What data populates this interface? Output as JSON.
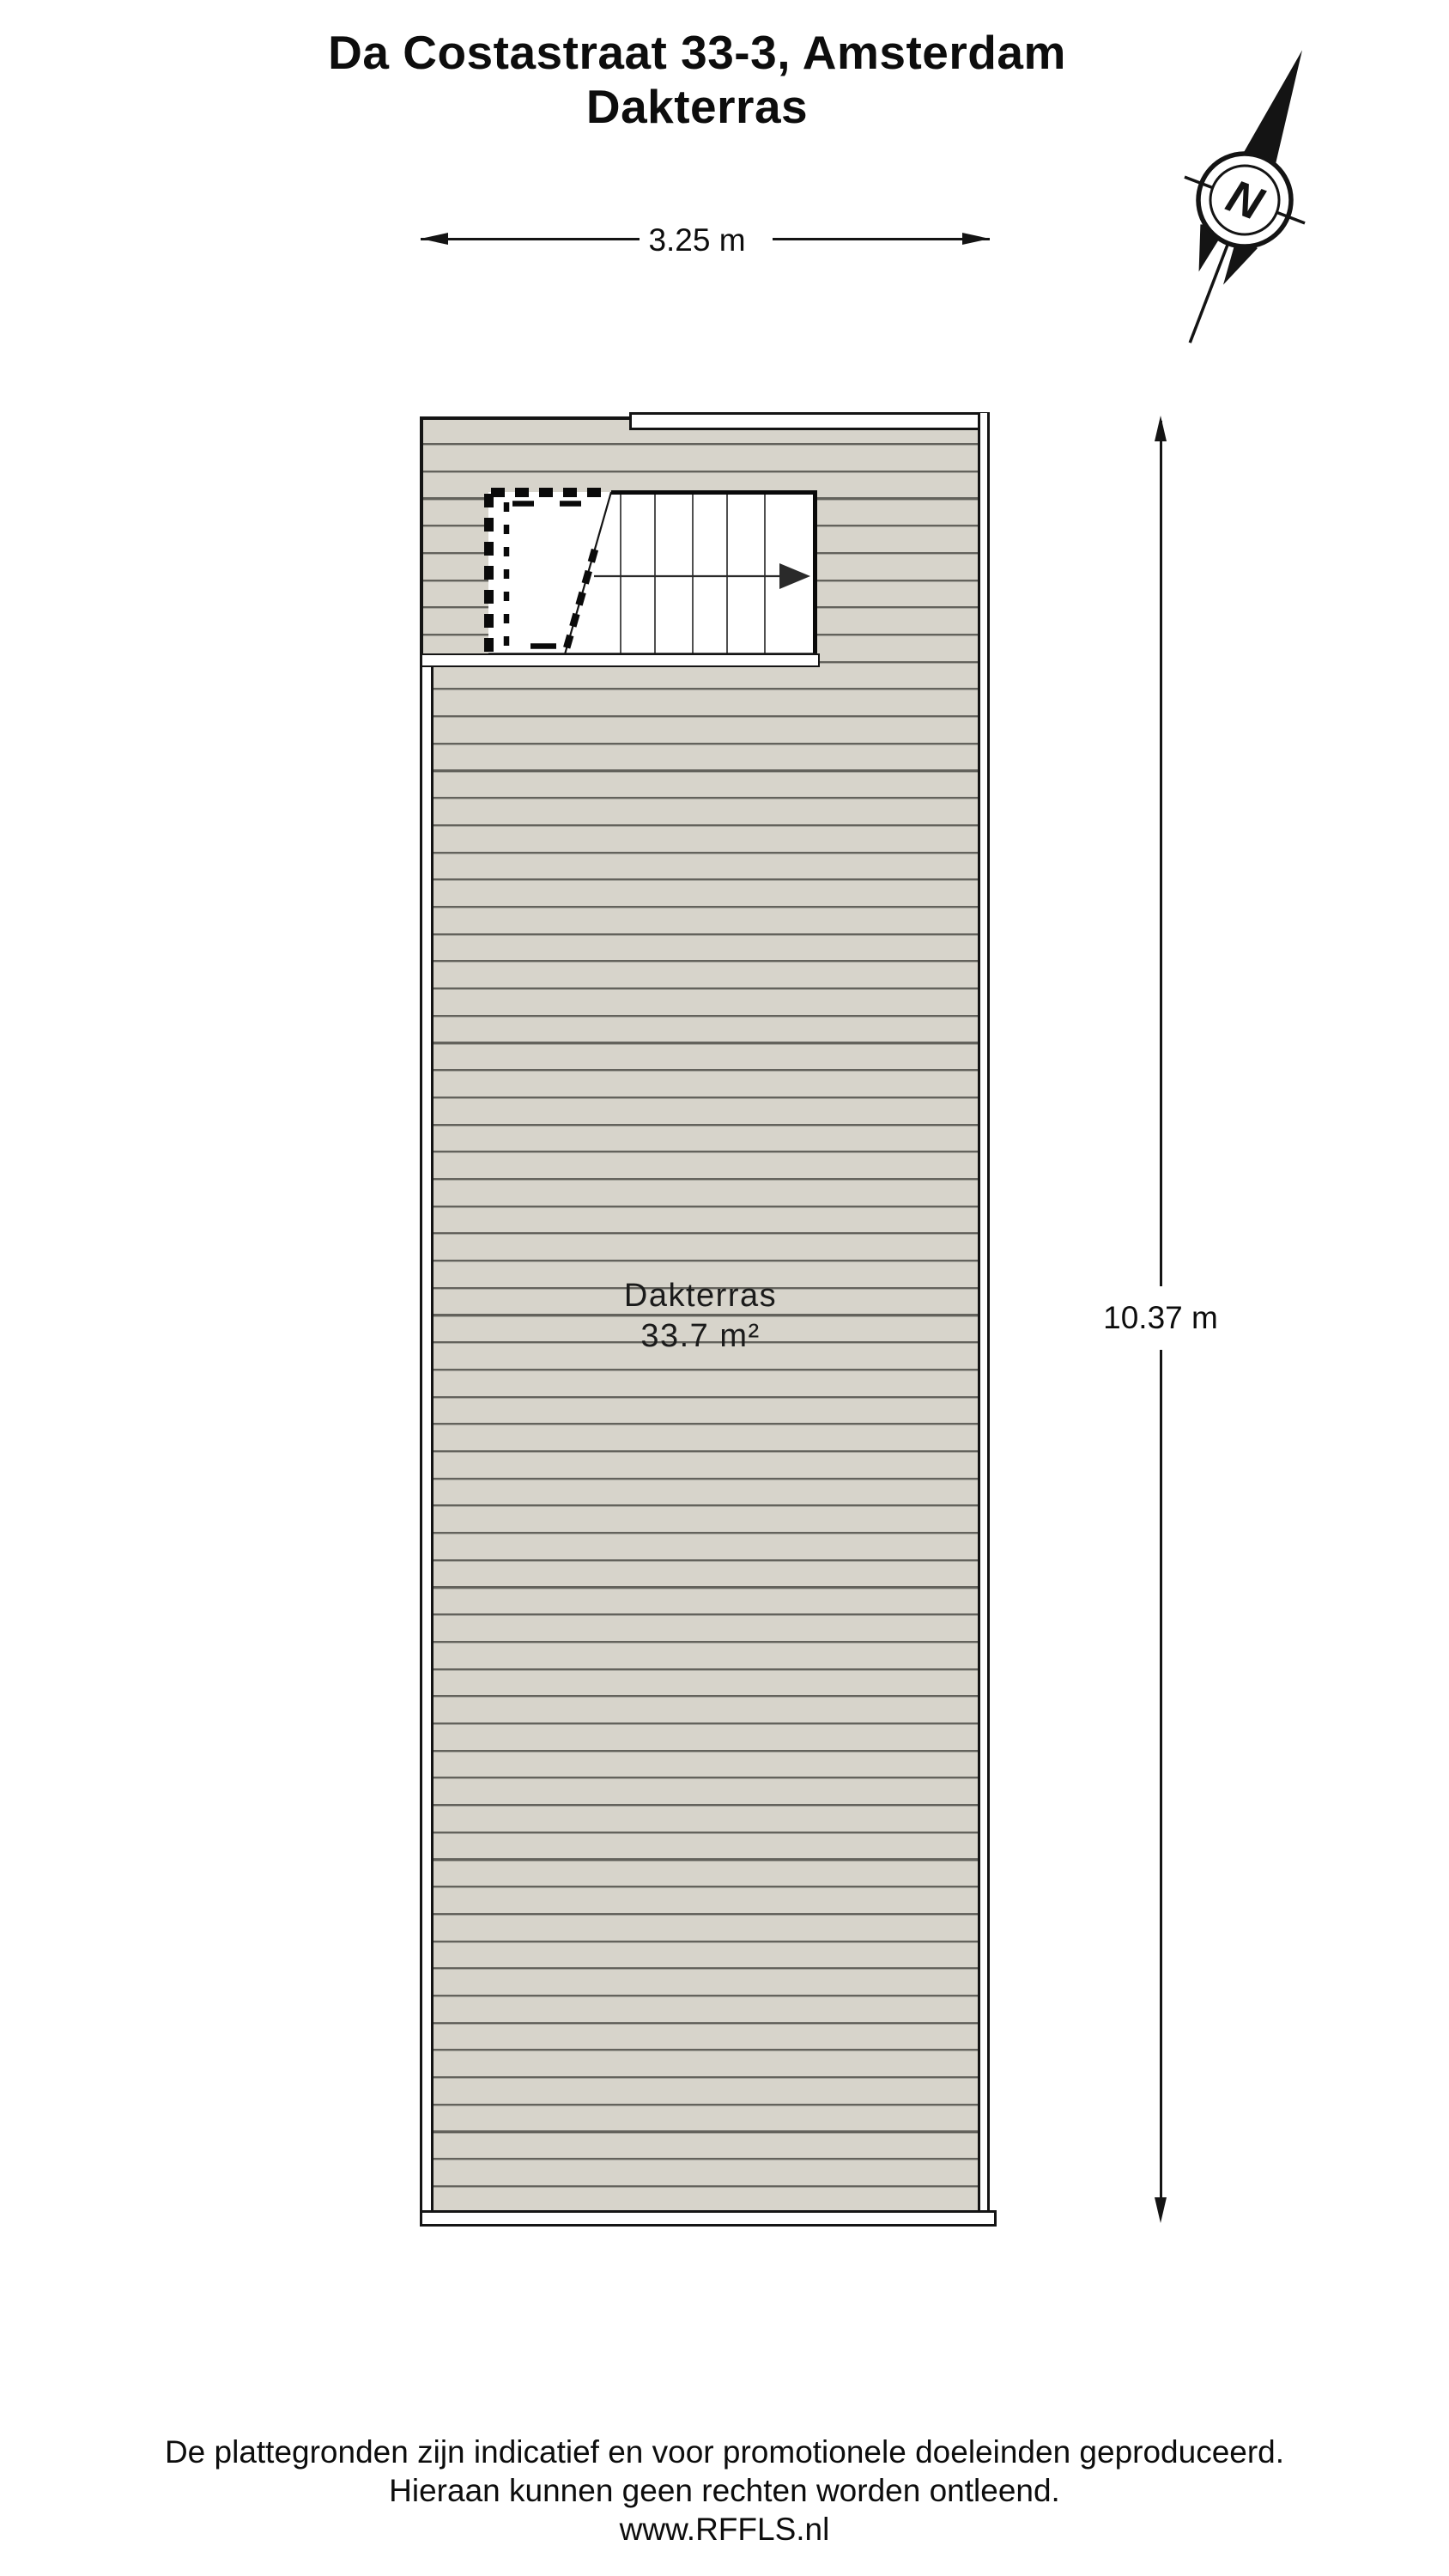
{
  "title": {
    "line1": "Da Costastraat 33-3, Amsterdam",
    "line2": "Dakterras"
  },
  "dimensions": {
    "width": "3.25 m",
    "height": "10.37 m"
  },
  "room": {
    "name": "Dakterras",
    "area": "33.7 m²"
  },
  "compass": {
    "north": "N"
  },
  "footer": {
    "line1": "De plattegronden zijn indicatief en voor promotionele doeleinden geproduceerd.",
    "line2": "Hieraan kunnen geen rechten worden ontleend.",
    "line3": "www.RFFLS.nl"
  },
  "colors": {
    "deck_fill": "#d7d4cb",
    "deck_line_dark": "#63625c",
    "deck_line_light": "#a8a79f",
    "wall": "#141414",
    "background": "#ffffff"
  }
}
